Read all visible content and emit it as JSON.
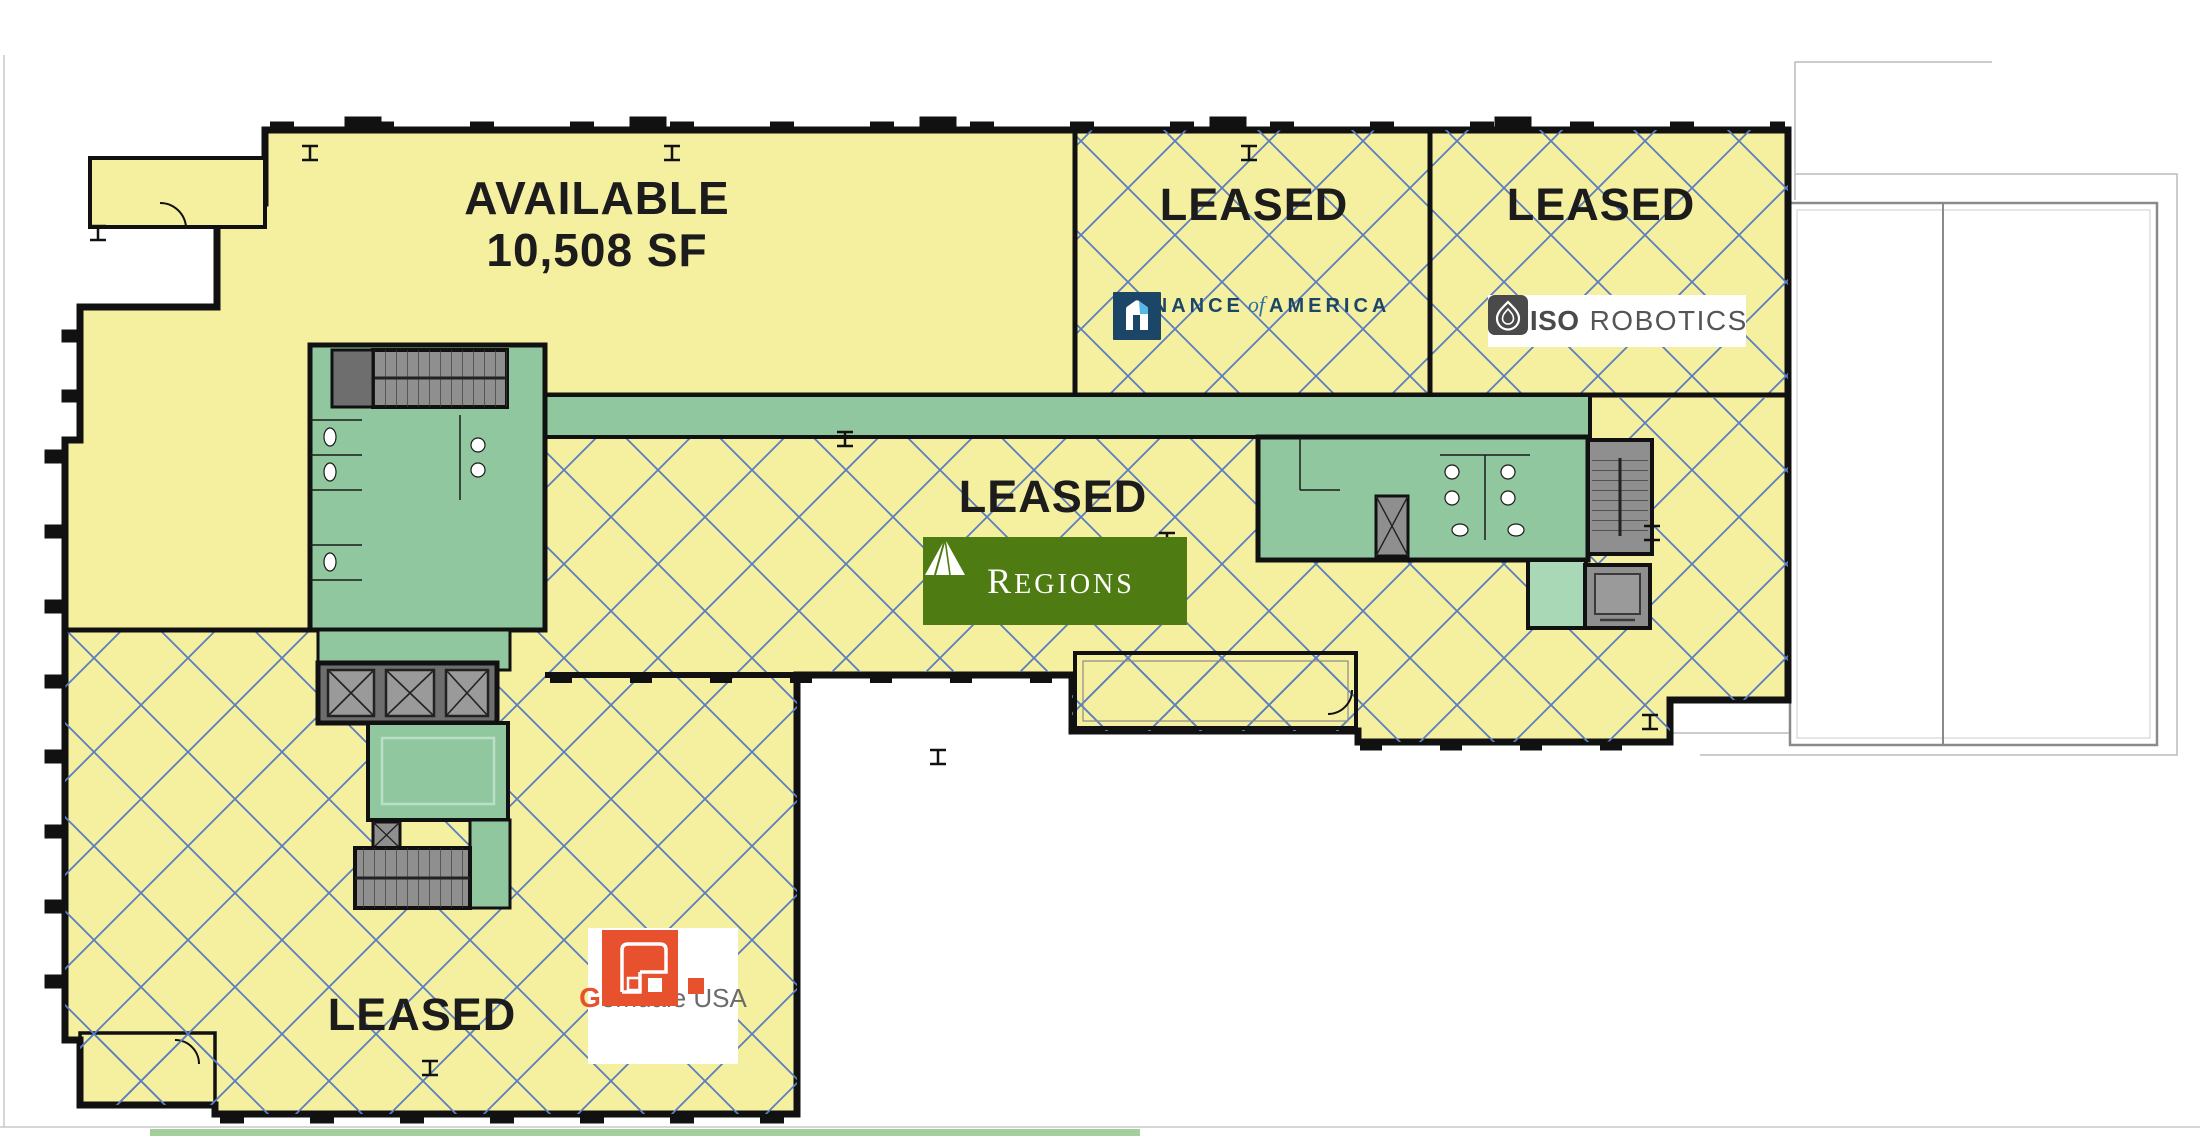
{
  "plan": {
    "available_suite": {
      "status_label": "AVAILABLE",
      "area_label": "10,508 SF"
    },
    "suites": [
      {
        "name": "finance-of-america-suite",
        "status_label": "LEASED"
      },
      {
        "name": "miso-robotics-suite",
        "status_label": "LEASED"
      },
      {
        "name": "regions-suite",
        "status_label": "LEASED"
      },
      {
        "name": "gemdale-usa-suite",
        "status_label": "LEASED"
      }
    ],
    "logos": {
      "finance_of_america": {
        "word1": "FINANCE",
        "word2": "of",
        "word3": "AMERICA",
        "icon": "house-f-icon",
        "navy": "#1C4668",
        "accent": "#57B8E8"
      },
      "miso_robotics": {
        "word1": "MISO",
        "word2": "ROBOTICS",
        "icon": "onion-icon",
        "color": "#4A4A4A"
      },
      "regions": {
        "word_initial": "R",
        "word_rest": "EGIONS",
        "icon": "pyramid-icon",
        "bg": "#4E7B12"
      },
      "gemdale": {
        "word_initial": "G",
        "word_rest": "emdale USA",
        "icon": "maze-g-icon",
        "orange": "#E8512D",
        "gray": "#6B6B6B"
      }
    },
    "colors": {
      "floor_yellow": "#F5EFA0",
      "hatch_blue": "#5B7EC0",
      "core_green": "#90C79E",
      "core_green_light": "#A9D8B6",
      "stair_gray": "#8F8F8F",
      "shaft_gray_dark": "#6E6E6E",
      "wall_black": "#111111"
    }
  }
}
